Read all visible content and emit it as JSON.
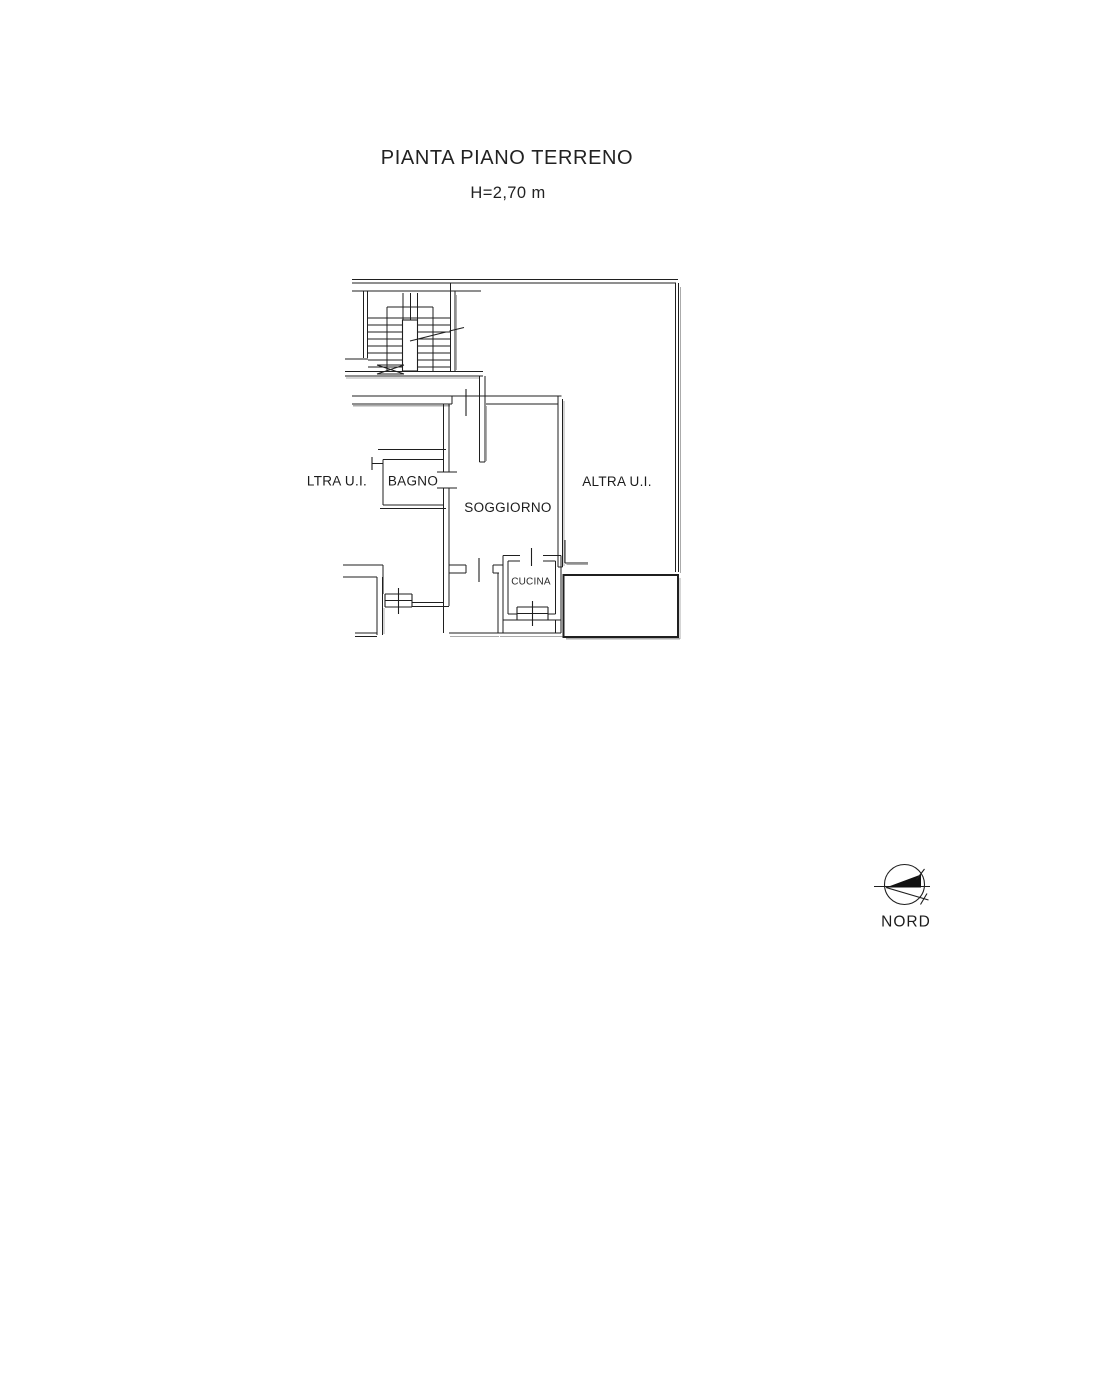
{
  "document": {
    "title": "PIANTA PIANO TERRENO",
    "subtitle": "H=2,70 m"
  },
  "floor_plan": {
    "rooms": [
      {
        "id": "ltra-ui",
        "label": "LTRA U.I."
      },
      {
        "id": "bagno",
        "label": "BAGNO"
      },
      {
        "id": "soggiorno",
        "label": "SOGGIORNO"
      },
      {
        "id": "altra-ui",
        "label": "ALTRA U.I."
      },
      {
        "id": "cucina",
        "label": "CUCINA"
      }
    ]
  },
  "compass": {
    "label": "NORD",
    "arrow_points": "left"
  },
  "colors": {
    "ink": "#1f1f1f",
    "shadow": "#ababab",
    "paper": "#ffffff"
  }
}
